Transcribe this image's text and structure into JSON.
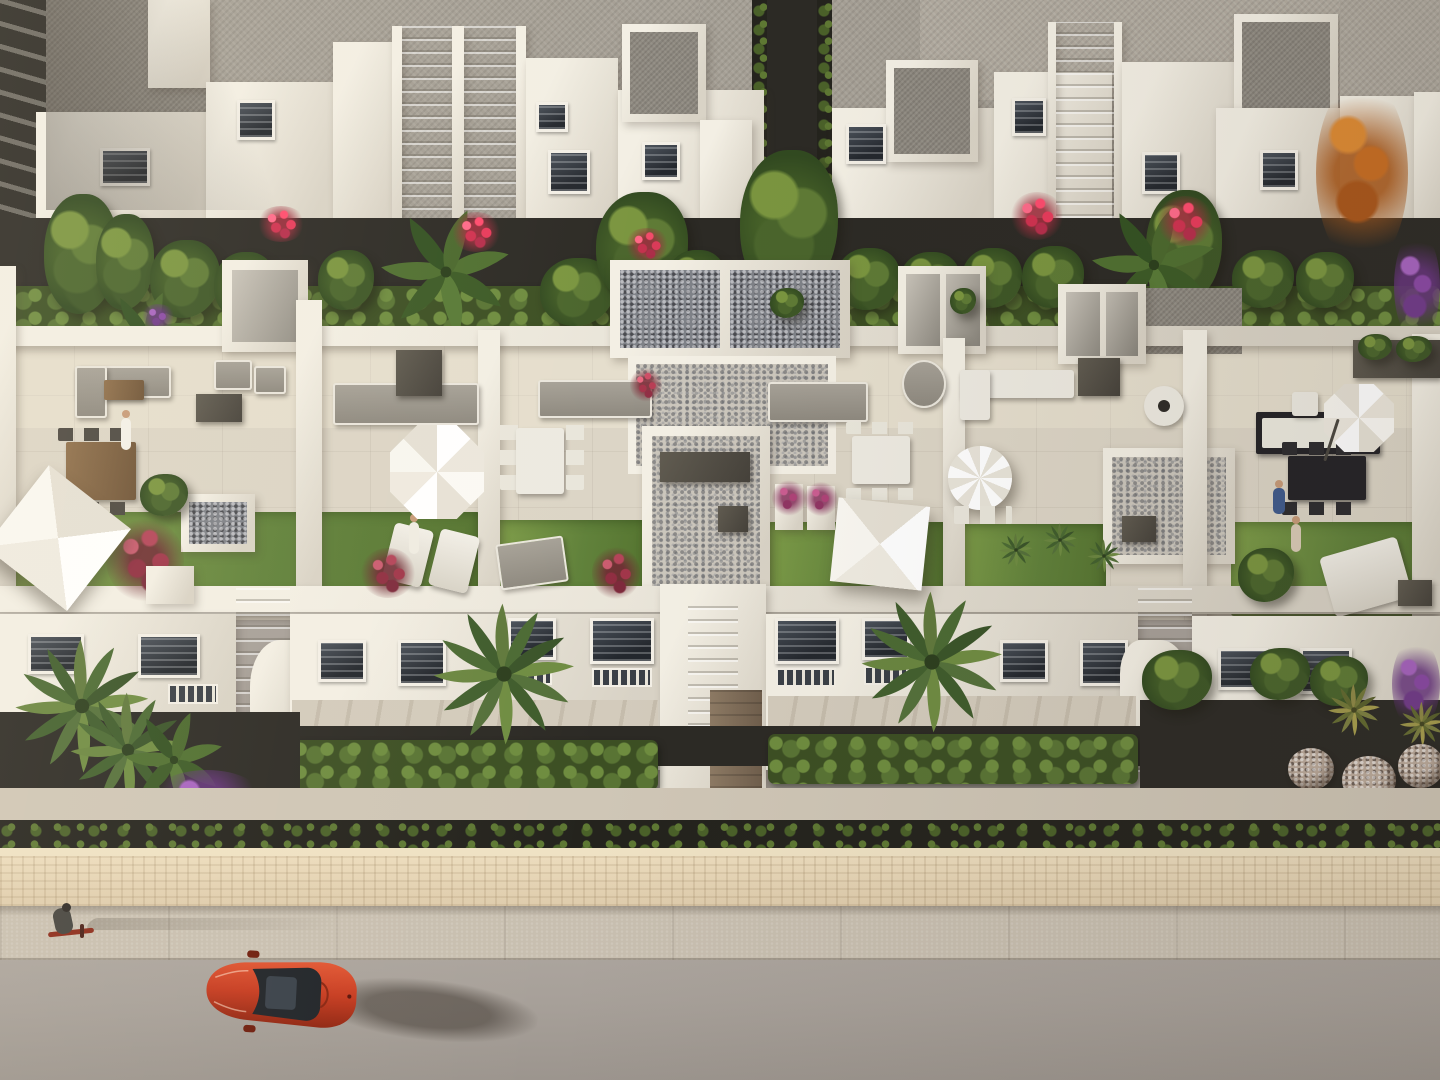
{
  "meta": {
    "title": "Aerial render — white townhouse complex with roof terraces",
    "description": "Bird's-eye 3D architectural rendering at golden hour: a back row of white villas with flat gravel roofs and twin exterior staircases; a front row of five penthouse roof terraces with lounge sofas, dining sets, white parasols, pebble patios and artificial lawns; louvered-window facades over clipped hedges, palm and banana trees with pink, red, orange and purple flowering shrubs; a sandstone retaining wall topped by a hedge above a sidewalk and asphalt road where a red car is parked and a person rides a red bicycle."
  },
  "palette": {
    "wallLit": "#f3efe4",
    "wallShade": "#d9d3c6",
    "wallDark": "#c4beb1",
    "roofGravel": "#a59f95",
    "roofDark": "#8e8980",
    "terraceFloor": "#dcd5c6",
    "pebble": "#cbc6bc",
    "pebbleDark": "#7e8187",
    "soil": "#2c2a25",
    "hedgeLit": "#5f7a36",
    "lawn": "#6f8f3d",
    "lawnShade": "#557430",
    "stoneWall": "#dcc9a9",
    "walkway": "#cfc6b6",
    "sidewalk": "#c8bfb0",
    "road": "#a7a099",
    "carRed": "#c63a1f",
    "carGlass": "#1f2328",
    "frameWhite": "#f3efe6",
    "wood": "#8f6f4b",
    "pink": "#bc4a5e",
    "redShrub": "#902e41",
    "orange": "#c76d22",
    "purple": "#7e4492",
    "blueFlower": "#5565b4",
    "umbrellaWhite": "#f7f5ef"
  },
  "scene": {
    "setting": "aerial view, golden-hour light, shadows cast to the right",
    "back_row": {
      "label": "white villas with flat gravel roofs",
      "exterior_staircases": 2,
      "rooftop_boxes": 3,
      "windows": 9
    },
    "terrace_row": {
      "label": "five penthouse roof terraces",
      "features": [
        "lounge sofas",
        "dining sets",
        "white parasols",
        "artificial lawns",
        "pebble patios",
        "stair bulkheads",
        "planters"
      ],
      "parasol_shapes": [
        "square",
        "octagonal",
        "square",
        "round",
        "octagonal"
      ],
      "people_on_terraces": 4
    },
    "facade_row": {
      "label": "white facades with louvered dark windows",
      "stairwells": 3
    },
    "garden_strip": {
      "hedges": "clipped bright-green rows",
      "palm_trees": 4,
      "banana_plants": 3,
      "flower_colors": [
        "pink",
        "red",
        "purple",
        "orange",
        "blue"
      ],
      "ornamental_rock_balls": 5,
      "autumn_tree": "orange"
    },
    "street": {
      "stone_retaining_wall": true,
      "wall_top_hedge": true,
      "sidewalk": true,
      "asphalt_road": true,
      "red_car": 1,
      "cyclist_with_red_bike": 1
    }
  }
}
